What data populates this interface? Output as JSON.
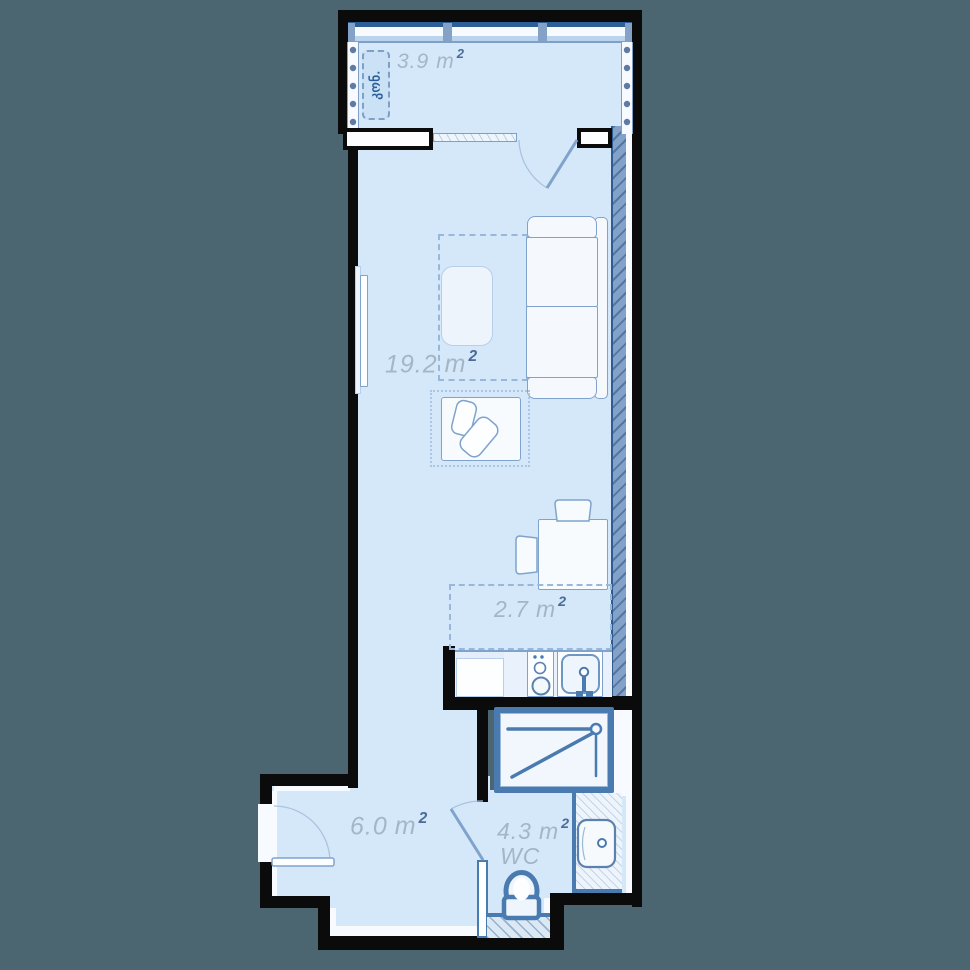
{
  "plan": {
    "title": "apartment-floor-plan",
    "rooms": {
      "balcony": {
        "area": "3.9",
        "unit": "m",
        "sup": "2"
      },
      "living": {
        "area": "19.2",
        "unit": "m",
        "sup": "2"
      },
      "kitchen": {
        "area": "2.7",
        "unit": "m",
        "sup": "2"
      },
      "hall": {
        "area": "6.0",
        "unit": "m",
        "sup": "2"
      },
      "wc": {
        "area": "4.3",
        "unit": "m",
        "sup": "2",
        "label": "WC"
      }
    },
    "annotations": {
      "ac_unit": "კონ."
    },
    "colors": {
      "background": "#4c6671",
      "floor": "#d5e8fa",
      "wall": "#0b0b0b",
      "structure_hatch": "#84a1c8",
      "fixture_accent": "#4a7bb0",
      "furniture_line": "#7fa3cc",
      "label_text": "#a4b5c6",
      "label_sup": "#4d6b99"
    }
  }
}
